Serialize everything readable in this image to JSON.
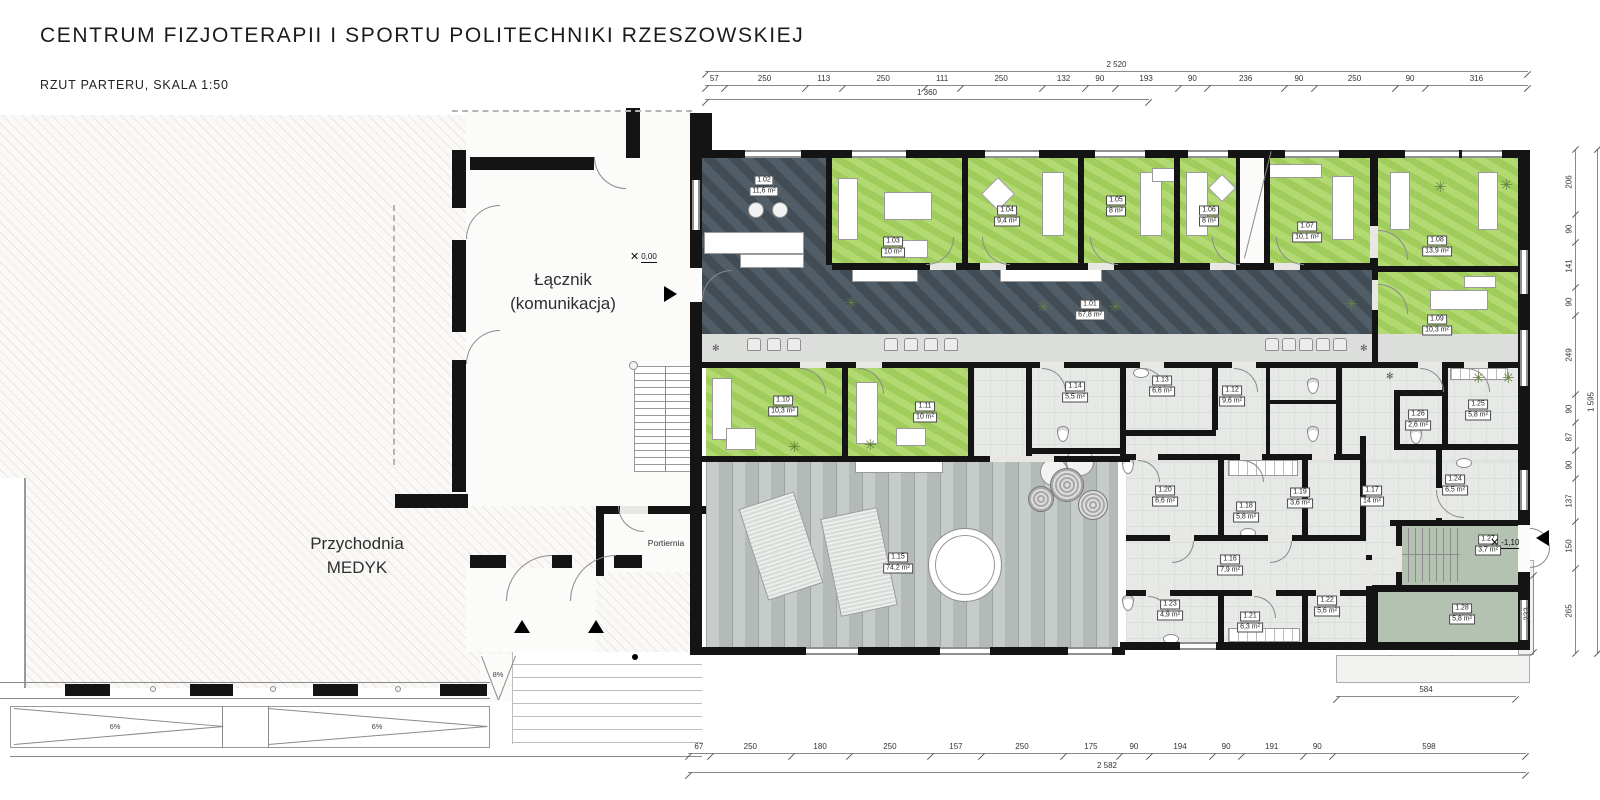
{
  "header": {
    "title": "CENTRUM FIZJOTERAPII I SPORTU POLITECHNIKI RZESZOWSKIEJ",
    "subtitle": "RZUT PARTERU, SKALA 1:50"
  },
  "legend": {
    "col_room": "Pomieszczenie",
    "col_area": "Powierzchnia",
    "rows": [
      {
        "label": "1.01 Hol",
        "area": "67,80 m²"
      },
      {
        "label": "1.02. Recepcja",
        "area": "11,60 m²"
      },
      {
        "label": "1.03 Gabinet konsultacyjny",
        "area": "10,00 m²"
      },
      {
        "label": "1.04 Gabinet do krioterapii miejscowej",
        "area": "9,40 m²"
      },
      {
        "label": "1.05 Gabinet terapii indywidualnej",
        "area": "8,00 m²"
      },
      {
        "label": "1.06 Gabinet terapii indywidualnej",
        "area": "8,00 m²"
      },
      {
        "label": "1.07 Gabinet do fizykoterapii-magnetoterapia",
        "area": "10,10 m²"
      },
      {
        "label": "1.08 Gabinet do światłolecznictwa",
        "area": "13,90 m²"
      },
      {
        "label": "1.09 Gabinet do laseroterapii",
        "area": "10,30 m²"
      },
      {
        "label": "1.10 Gabinet do elektroterapii i ultradźwięków",
        "area": "10,30 m²"
      },
      {
        "label": "1.11 Gabinet do terapii fali uderzeniowej",
        "area": "10,00 m²"
      },
      {
        "label": "1.12 Toaleta damska",
        "area": "9,60 m²"
      },
      {
        "label": "1.13 Toaleta męska",
        "area": "6,60 m²"
      },
      {
        "label": "1.14 Toaleta dla niepełnosprawnego",
        "area": "5,50 m²"
      },
      {
        "label": "1.15 Salka do ćwiczeń",
        "area": "74,20 m²"
      },
      {
        "label": "1.16 Komunikacja 1",
        "area": "7,90 m²"
      },
      {
        "label": "1.17 Komunikacja 2",
        "area": "14,00 m²"
      },
      {
        "label": "1.18 Szatnia damska",
        "area": "5,80 m²"
      },
      {
        "label": "1.19 Prysznice damskie",
        "area": "3,60 m²"
      },
      {
        "label": "1.20 Toaleta damska",
        "area": "6,60 m²"
      },
      {
        "label": "1.21 Szatnia męska",
        "area": "6,30 m²"
      },
      {
        "label": "1.22 Prysznice męskie",
        "area": "5,60 m²"
      },
      {
        "label": "1.23 Toaleta męska",
        "area": "4,90 m²"
      },
      {
        "label": "1.24 Pokój socjalny",
        "area": "6,50 m²"
      },
      {
        "label": "1.25 Szatnia personelu",
        "area": "5,80 m²"
      },
      {
        "label": "1.26 Toaleta personelu",
        "area": "2,60 m²"
      },
      {
        "label": "1.27 Klatka schodowa (techniczna)",
        "area": "3,70 m²"
      },
      {
        "label": "1.28. Pomieszczenie gospodarcze",
        "area": "5,80 m²"
      }
    ]
  },
  "plan": {
    "labels": {
      "lacznik_line1": "Łącznik",
      "lacznik_line2": "(komunikacja)",
      "medyk_line1": "Przychodnia",
      "medyk_line2": "MEDYK",
      "portiernia": "Portiernia",
      "level_zero": "0,00",
      "level_minus": "-1,10",
      "ramp_left": "6%",
      "ramp_right": "6%",
      "ramp_small": "8%"
    },
    "rooms": [
      {
        "id": "1.01",
        "area": "67,8 m²"
      },
      {
        "id": "1.02",
        "area": "11,6 m²"
      },
      {
        "id": "1.03",
        "area": "10 m²"
      },
      {
        "id": "1.04",
        "area": "9,4 m²"
      },
      {
        "id": "1.05",
        "area": "8 m²"
      },
      {
        "id": "1.06",
        "area": "8 m²"
      },
      {
        "id": "1.07",
        "area": "10,1 m²"
      },
      {
        "id": "1.08",
        "area": "13,9 m²"
      },
      {
        "id": "1.09",
        "area": "10,3 m²"
      },
      {
        "id": "1.10",
        "area": "10,3 m²"
      },
      {
        "id": "1.11",
        "area": "10 m²"
      },
      {
        "id": "1.12",
        "area": "9,6 m²"
      },
      {
        "id": "1.13",
        "area": "6,6 m²"
      },
      {
        "id": "1.14",
        "area": "5,5 m²"
      },
      {
        "id": "1.15",
        "area": "74,2 m²"
      },
      {
        "id": "1.16",
        "area": "7,9 m²"
      },
      {
        "id": "1.17",
        "area": "14 m²"
      },
      {
        "id": "1.18",
        "area": "5,8 m²"
      },
      {
        "id": "1.19",
        "area": "3,6 m²"
      },
      {
        "id": "1.20",
        "area": "6,6 m²"
      },
      {
        "id": "1.21",
        "area": "6,3 m²"
      },
      {
        "id": "1.22",
        "area": "5,6 m²"
      },
      {
        "id": "1.23",
        "area": "4,9 m²"
      },
      {
        "id": "1.24",
        "area": "6,5 m²"
      },
      {
        "id": "1.25",
        "area": "5,8 m²"
      },
      {
        "id": "1.26",
        "area": "2,6 m²"
      },
      {
        "id": "1.27",
        "area": "3,7 m²"
      },
      {
        "id": "1.28",
        "area": "5,8 m²"
      }
    ]
  },
  "dimensions": {
    "top_total": "2 520",
    "top_segments": [
      "57",
      "250",
      "113",
      "250",
      "111",
      "250",
      "132",
      "90",
      "193",
      "90",
      "236",
      "90",
      "250",
      "90",
      "316"
    ],
    "top_partial": "1 360",
    "bottom_segments": [
      "67",
      "250",
      "180",
      "250",
      "157",
      "250",
      "175",
      "90",
      "194",
      "90",
      "191",
      "90",
      "598"
    ],
    "bottom_total": "2 582",
    "right_segments": [
      "206",
      "90",
      "141",
      "90",
      "249",
      "90",
      "87",
      "90",
      "137",
      "150",
      "265"
    ],
    "right_total": "1 595",
    "right_extra": "233",
    "terrace_width": "584"
  }
}
